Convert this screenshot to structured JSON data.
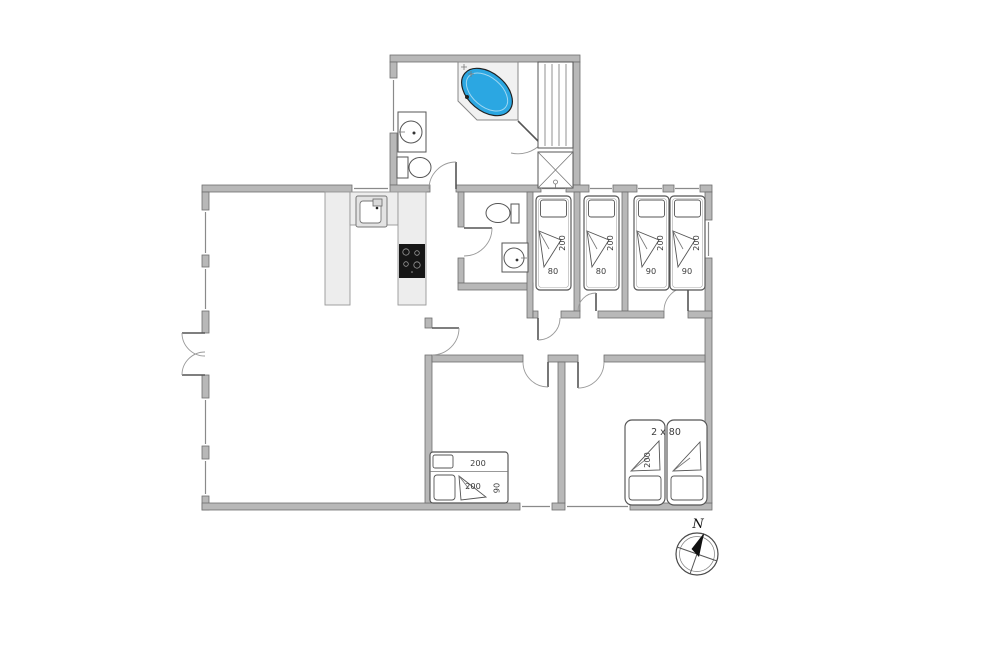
{
  "plan": {
    "compass": {
      "north_label": "N"
    },
    "bedroom_top_1": {
      "bed_length": "200",
      "bed_width": "80"
    },
    "bedroom_top_2": {
      "bed_length": "200",
      "bed_width": "80"
    },
    "bedroom_top_3": {
      "bed_a_length": "200",
      "bed_a_width": "90",
      "bed_b_length": "200",
      "bed_b_width": "90"
    },
    "bedroom_bottom_mid": {
      "bunk_top_length": "200",
      "bed_length": "200",
      "bed_width": "90"
    },
    "bedroom_bottom_right": {
      "bed_label": "2 x 80",
      "bed_length": "200"
    }
  },
  "colors": {
    "bathtub_blue": "#2BA7E2",
    "cooktop_black": "#161616",
    "wall_gray": "#B8B8B8",
    "counter_gray": "#EDEDED"
  }
}
